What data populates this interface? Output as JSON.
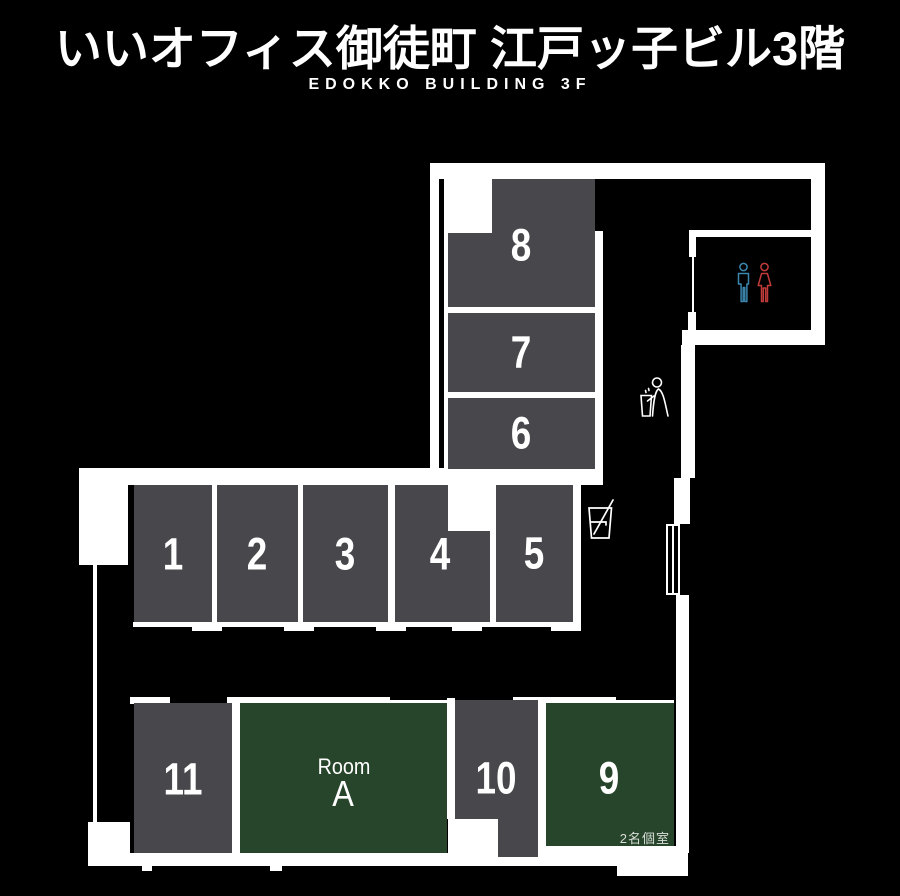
{
  "header": {
    "title": "いいオフィス御徒町 江戸ッ子ビル3階",
    "subtitle": "EDOKKO BUILDING 3F"
  },
  "rooms": {
    "r1": {
      "label": "1",
      "type": "booth"
    },
    "r2": {
      "label": "2",
      "type": "booth"
    },
    "r3": {
      "label": "3",
      "type": "booth"
    },
    "r4": {
      "label": "4",
      "type": "booth"
    },
    "r5": {
      "label": "5",
      "type": "booth"
    },
    "r6": {
      "label": "6",
      "type": "booth"
    },
    "r7": {
      "label": "7",
      "type": "booth"
    },
    "r8": {
      "label": "8",
      "type": "booth"
    },
    "r9": {
      "label": "9",
      "type": "green-room",
      "note": "2名個室"
    },
    "r10": {
      "label": "10",
      "type": "booth"
    },
    "r11": {
      "label": "11",
      "type": "booth"
    },
    "roomA": {
      "label_small": "Room",
      "label": "A",
      "type": "green-room"
    }
  },
  "icons": {
    "restroom": "restroom-men-women-icon",
    "trash": "trash-disposal-icon",
    "drink": "drink-cup-icon",
    "door": "sliding-door-symbol"
  },
  "colors": {
    "bg": "#000000",
    "wall": "#ffffff",
    "room-gray": "#47474c",
    "room-green": "#27452a",
    "men-blue": "#3c87ae",
    "women-red": "#c23b3b",
    "note-text": "#d9ded9"
  }
}
